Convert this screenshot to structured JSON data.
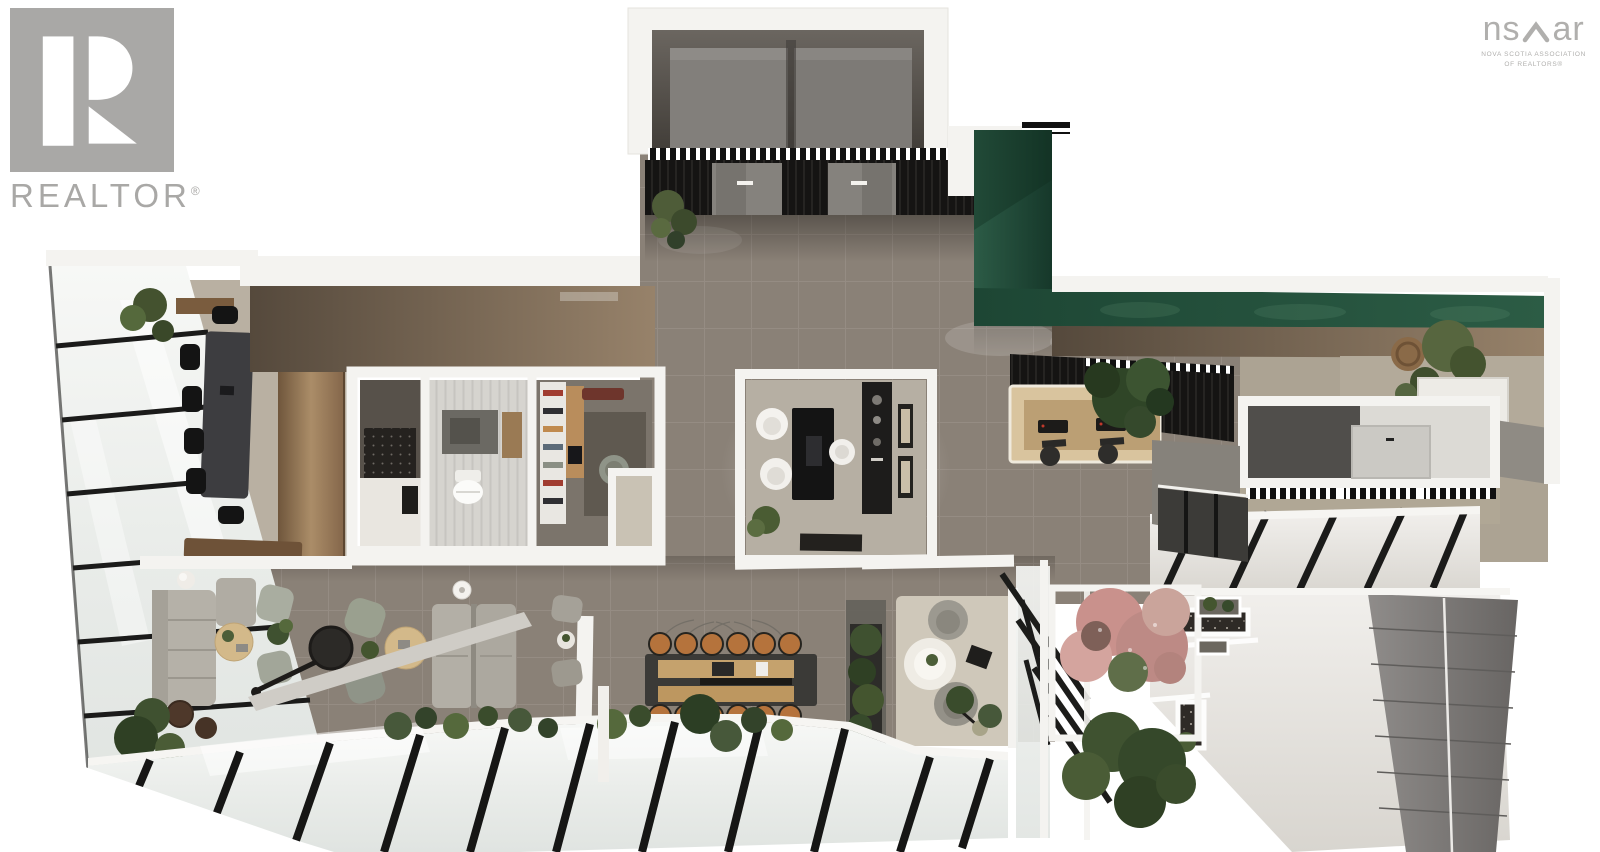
{
  "branding": {
    "realtor": {
      "wordmark": "REALTOR",
      "registered": "®"
    },
    "nsar": {
      "prefix": "ns",
      "suffix": "ar",
      "tagline_line1": "NOVA SCOTIA ASSOCIATION",
      "tagline_line2": "OF REALTORS®"
    }
  },
  "palette": {
    "page-bg": "#ffffff",
    "logo-gray": "#a9a8a6",
    "nsar-gray": "#b0afad",
    "floor-tile": "#8a8177",
    "floor-warm": "#b9b0a2",
    "wall-white": "#f4f3f0",
    "wall-brown": "#8d7a66",
    "green-dark": "#1c4433",
    "green-mid": "#2b5a44",
    "slat-black": "#151413",
    "wood": "#c5a26d",
    "wood-dark": "#7a5c3e",
    "glass-white": "#eef1ee",
    "mullion-black": "#1b1b1a",
    "sofa-gray": "#b5b1a8",
    "chair-green": "#8f9488",
    "concrete": "#e6e3de",
    "panel-gray": "#7d7a77",
    "plant-green": "#47583a",
    "plant-dark": "#2f4024",
    "blossom-pink": "#c9918c",
    "stool-tan": "#b5733c"
  }
}
